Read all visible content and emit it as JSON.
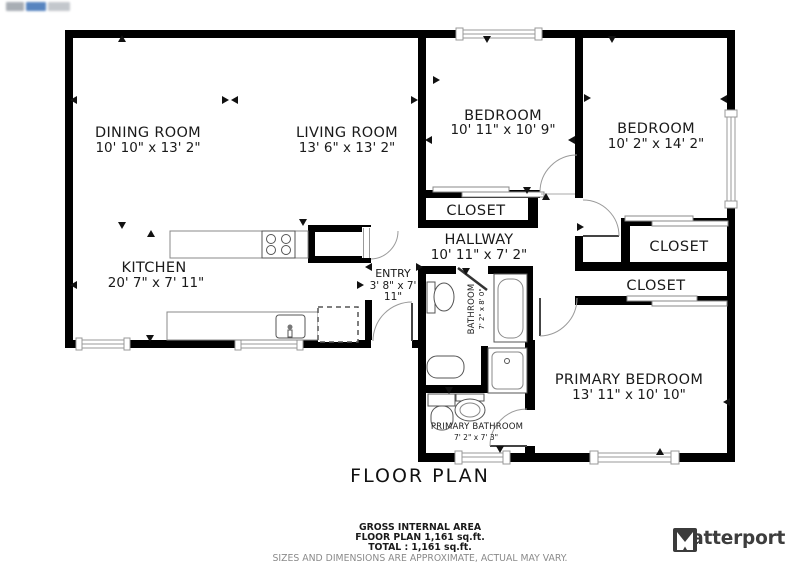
{
  "plan": {
    "title": "FLOOR PLAN",
    "rooms": {
      "dining": {
        "name": "DINING ROOM",
        "dims": "10' 10\" x 13' 2\""
      },
      "living": {
        "name": "LIVING ROOM",
        "dims": "13' 6\" x 13' 2\""
      },
      "bedroom_top": {
        "name": "BEDROOM",
        "dims": "10' 11\" x 10' 9\""
      },
      "bedroom_right": {
        "name": "BEDROOM",
        "dims": "10' 2\" x 14' 2\""
      },
      "kitchen": {
        "name": "KITCHEN",
        "dims": "20' 7\" x 7' 11\""
      },
      "entry": {
        "name": "ENTRY",
        "dims_line1": "3' 8\" x 7'",
        "dims_line2": "11\""
      },
      "hallway": {
        "name": "HALLWAY",
        "dims": "10' 11\" x 7' 2\""
      },
      "bathroom": {
        "name": "BATHROOM",
        "dims": "7' 2\" x 8' 0\""
      },
      "primary_bathroom": {
        "name": "PRIMARY BATHROOM",
        "dims": "7' 2\" x 7' 3\""
      },
      "primary_bedroom": {
        "name": "PRIMARY BEDROOM",
        "dims": "13' 11\" x 10' 10\""
      },
      "closet_hall": {
        "name": "CLOSET"
      },
      "closet_bedroom": {
        "name": "CLOSET"
      },
      "closet_primary": {
        "name": "CLOSET"
      }
    }
  },
  "footer": {
    "area_heading": "GROSS INTERNAL AREA",
    "floor_area": "FLOOR PLAN 1,161 sq.ft.",
    "total_area": "TOTAL :  1,161 sq.ft.",
    "disclaimer": "SIZES AND DIMENSIONS ARE APPROXIMATE, ACTUAL MAY VARY."
  },
  "branding": {
    "name": "Matterport"
  },
  "colors": {
    "wall": "#000000",
    "door_arc": "#9a9a9a",
    "fixture": "#555555",
    "text": "#1a1a1a",
    "disclaimer_text": "#8a8a8a",
    "logo": "#3d3d3d"
  }
}
